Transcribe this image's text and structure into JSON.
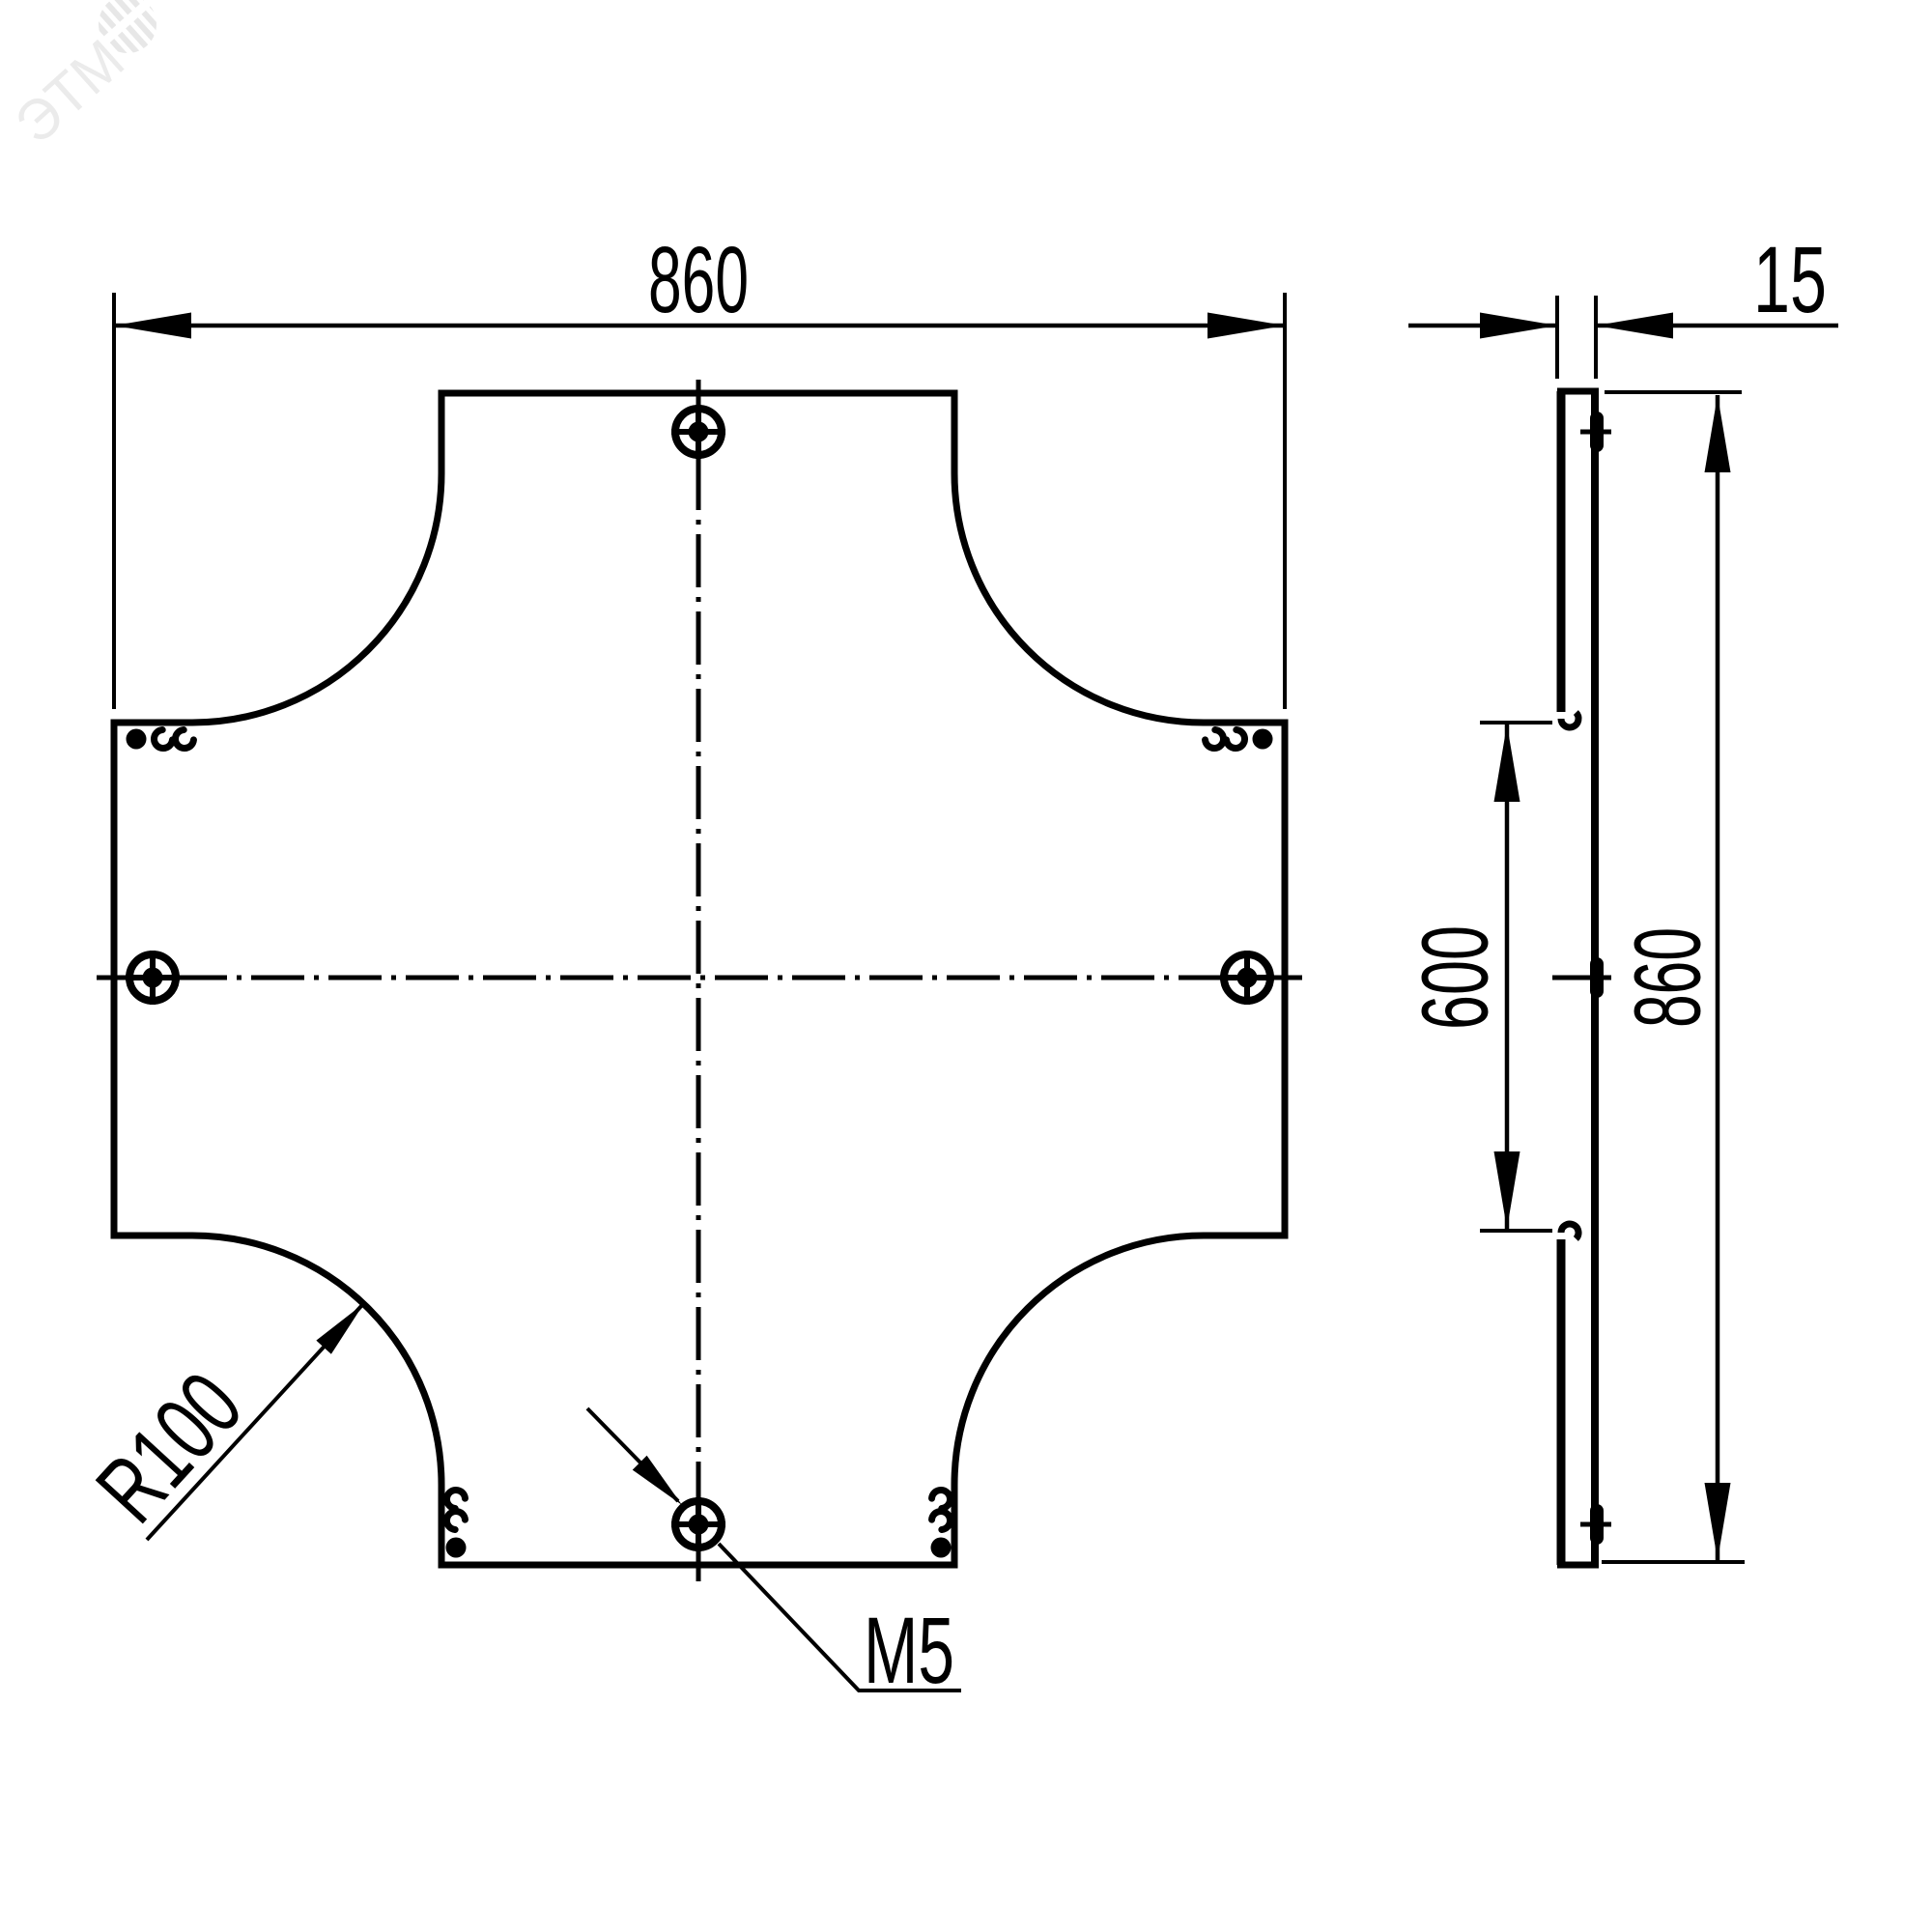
{
  "colors": {
    "ink": "#000000",
    "background": "#ffffff",
    "watermark": "#ebebeb"
  },
  "watermark": {
    "logo_text": "ЭТМ"
  },
  "plan_view": {
    "width_dim": "860",
    "radius_label": "R100",
    "thread_label": "M5"
  },
  "side_view": {
    "thickness_dim": "15",
    "opening_dim": "600",
    "height_dim": "860"
  }
}
